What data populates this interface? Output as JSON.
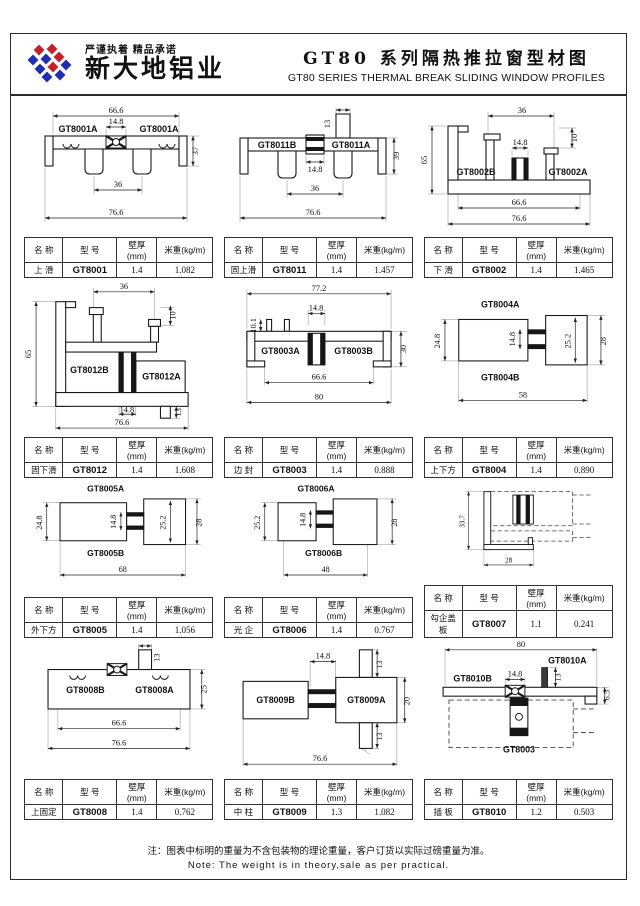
{
  "header": {
    "slogan": "严谨执着 精品承诺",
    "company": "新大地铝业",
    "title_cn": "GT80 系列隔热推拉窗型材图",
    "title_en": "GT80  SERIES THERMAL BREAK SLIDING WINDOW PROFILES"
  },
  "table_headers": {
    "name": "名 称",
    "model": "型 号",
    "thickness": "壁厚(mm)",
    "weight": "米重(kg/m)"
  },
  "cells": [
    {
      "table": {
        "name": "上 滑",
        "model": "GT8001",
        "thickness": "1.4",
        "weight": "1.082"
      },
      "parts": [
        "GT8001A",
        "GT8001A"
      ],
      "dims": [
        "66.6",
        "14.8",
        "37",
        "36",
        "76.6"
      ]
    },
    {
      "table": {
        "name": "固上滑",
        "model": "GT8011",
        "thickness": "1.4",
        "weight": "1.457"
      },
      "parts": [
        "GT8011B",
        "GT8011A"
      ],
      "dims": [
        "13",
        "14.8",
        "39",
        "36",
        "76.6"
      ]
    },
    {
      "table": {
        "name": "下 滑",
        "model": "GT8002",
        "thickness": "1.4",
        "weight": "1.465"
      },
      "parts": [
        "GT8002B",
        "GT8002A"
      ],
      "dims": [
        "36",
        "10",
        "14.8",
        "65",
        "66.6",
        "76.6"
      ]
    },
    {
      "table": {
        "name": "固下滑",
        "model": "GT8012",
        "thickness": "1.4",
        "weight": "1.608"
      },
      "parts": [
        "GT8012B",
        "GT8012A"
      ],
      "dims": [
        "65",
        "36",
        "10",
        "14.8",
        "13",
        "76.6"
      ]
    },
    {
      "table": {
        "name": "边 封",
        "model": "GT8003",
        "thickness": "1.4",
        "weight": "0.888"
      },
      "parts": [
        "GT8003A",
        "GT8003B"
      ],
      "dims": [
        "77.2",
        "10.1",
        "14.8",
        "30",
        "66.6",
        "80"
      ]
    },
    {
      "table": {
        "name": "上下方",
        "model": "GT8004",
        "thickness": "1.4",
        "weight": "0.890"
      },
      "parts": [
        "GT8004A",
        "GT8004B"
      ],
      "dims": [
        "24.8",
        "14.8",
        "25.2",
        "28",
        "58"
      ]
    },
    {
      "table": {
        "name": "外下方",
        "model": "GT8005",
        "thickness": "1.4",
        "weight": "1.056"
      },
      "parts": [
        "GT8005A",
        "GT8005B"
      ],
      "dims": [
        "24.8",
        "14.8",
        "25.2",
        "28",
        "68"
      ]
    },
    {
      "table": {
        "name": "光 企",
        "model": "GT8006",
        "thickness": "1.4",
        "weight": "0.767"
      },
      "parts": [
        "GT8006A",
        "GT8006B"
      ],
      "dims": [
        "25.2",
        "14.8",
        "28",
        "48"
      ]
    },
    {
      "table": {
        "name": "勾企盖板",
        "model": "GT8007",
        "thickness": "1.1",
        "weight": "0.241"
      },
      "parts": [],
      "dims": [
        "33.7",
        "28"
      ]
    },
    {
      "table": {
        "name": "上固定",
        "model": "GT8008",
        "thickness": "1.4",
        "weight": "0.762"
      },
      "parts": [
        "GT8008B",
        "GT8008A"
      ],
      "dims": [
        "13",
        "25",
        "66.6",
        "76.6"
      ]
    },
    {
      "table": {
        "name": "中 柱",
        "model": "GT8009",
        "thickness": "1.3",
        "weight": "1.082"
      },
      "parts": [
        "GT8009B",
        "GT8009A"
      ],
      "dims": [
        "14.8",
        "13",
        "20",
        "13",
        "76.6"
      ]
    },
    {
      "table": {
        "name": "插 板",
        "model": "GT8010",
        "thickness": "1.2",
        "weight": "0.503"
      },
      "parts": [
        "GT8010A",
        "GT8010B",
        "GT8003"
      ],
      "dims": [
        "80",
        "14.8",
        "13",
        "6.5"
      ]
    }
  ],
  "footer": {
    "note_cn": "注：图表中标明的重量为不含包装物的理论重量，客户订货以实际过磅重量为准。",
    "note_en": "Note: The weight is in theory,sale as per practical."
  }
}
